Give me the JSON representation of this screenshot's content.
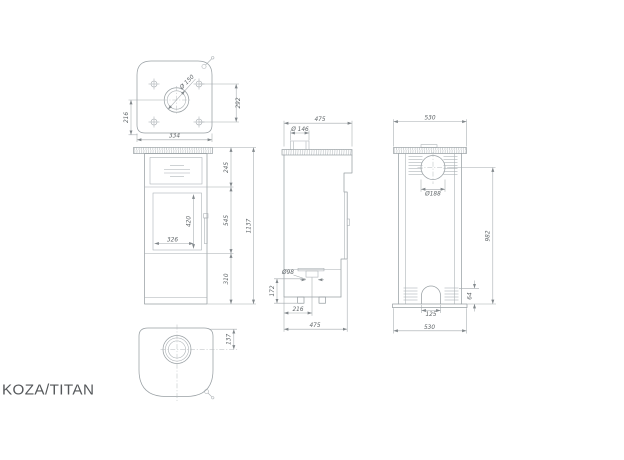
{
  "title": "KOZA/TITAN",
  "dimensions": {
    "top_view": {
      "flue": "Ø 150",
      "depth_left": "216",
      "hole_spacing": "292",
      "width": "334"
    },
    "front_view": {
      "upper_section": "245",
      "door_section": "545",
      "base_section": "310",
      "total_height": "1137",
      "glass_height": "420",
      "glass_width": "326"
    },
    "side_view": {
      "depth_top": "475",
      "collar": "Ø 146",
      "air_inlet": "Ø98",
      "inlet_height": "172",
      "inlet_offset": "216",
      "depth_bottom": "475"
    },
    "back_view": {
      "width_top": "530",
      "outlet": "Ø188",
      "outlet_center_height": "982",
      "arch_height": "64",
      "arch_width": "125",
      "width_bottom": "530"
    },
    "bottom_view": {
      "flue_offset": "137"
    }
  }
}
